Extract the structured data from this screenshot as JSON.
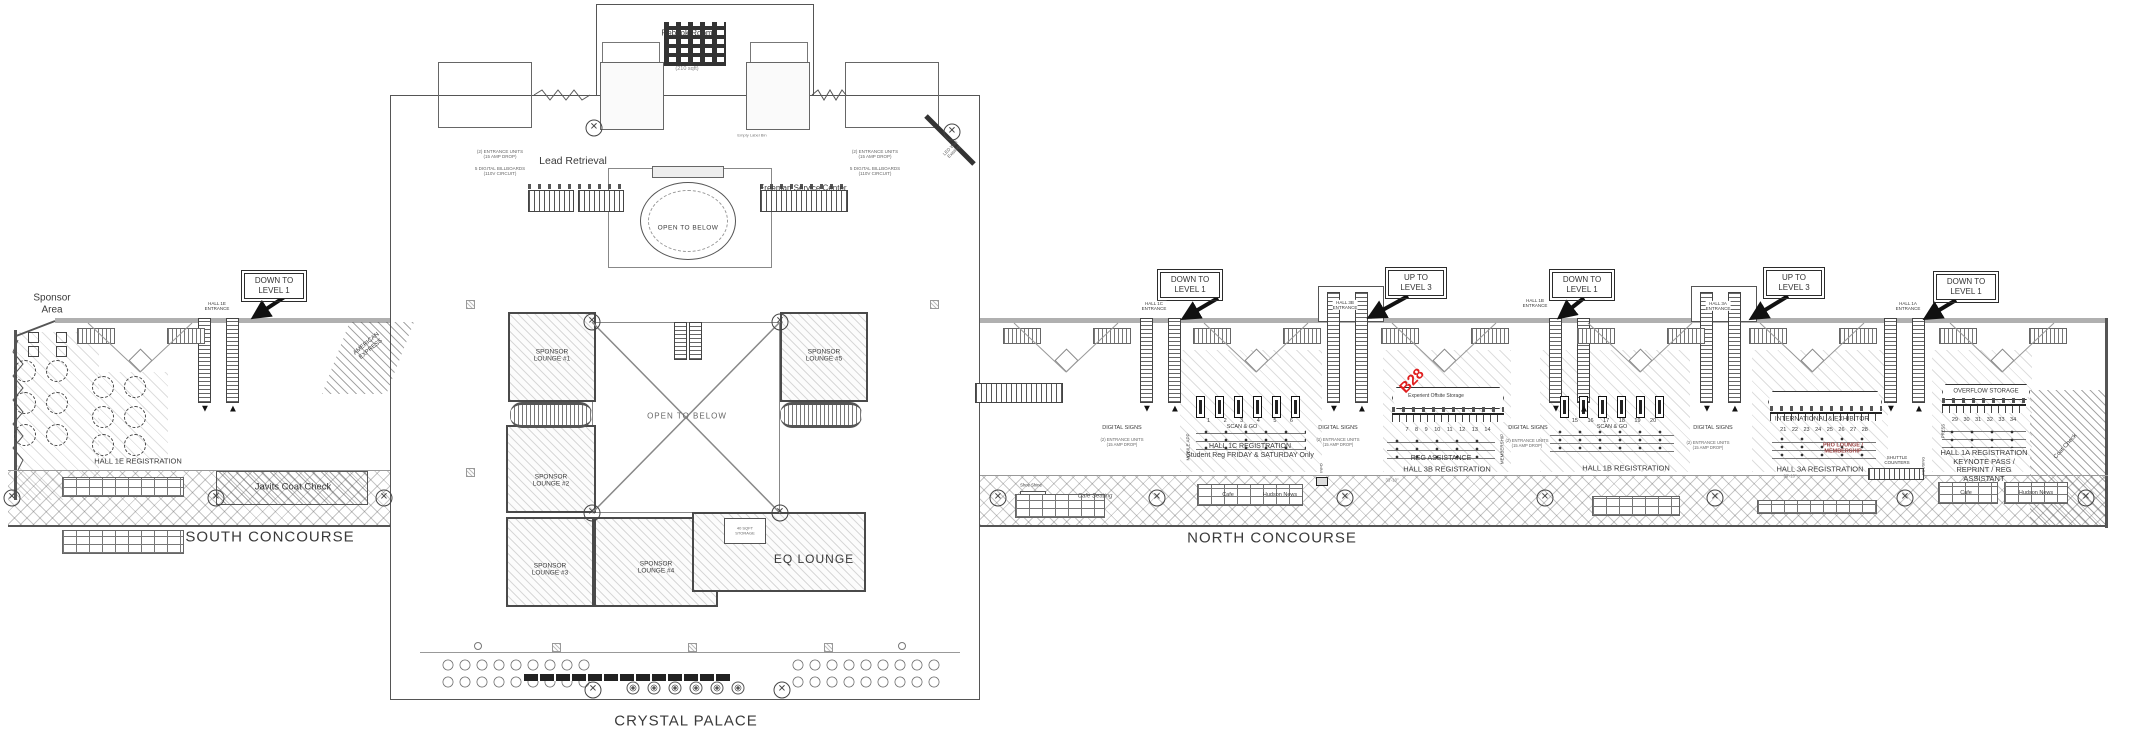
{
  "colors": {
    "b28_red": "#e01f1f",
    "pro_lounge_red": "#9c4444",
    "wall_gray": "#b0b0b0",
    "line": "#3c3c3c"
  },
  "icons": {
    "column_x": "✕",
    "esc_down": "▼",
    "esc_up": "▲"
  },
  "labels": {
    "rebook_room": "Rebook Room",
    "rebook_sqft": "(210 sqft)",
    "lead_retrieval": "Lead Retrieval",
    "freeman_service": "Freeman Service Center",
    "empty_label_bin": "Empty Label Bin",
    "open_to_below_rotunda": "OPEN TO BELOW",
    "open_to_below_atrium": "OPEN TO BELOW",
    "entrance_units": "(2) ENTRANCE UNITS\n(15 AMP DROP)",
    "digital_billboards": "5 DIGITAL BILLBOARDS\n(110V CIRCUIT)",
    "digital_signs": "DIGITAL SIGNS",
    "led_wall": "LED Wall\nExisting",
    "sponsor_area": "Sponsor\nArea",
    "hall_1e_registration": "HALL 1E REGISTRATION",
    "javits_coat_check": "Javits Coat Check",
    "american_express": "AMERICAN\nEXPRESS",
    "south_concourse": "SOUTH CONCOURSE",
    "north_concourse": "NORTH CONCOURSE",
    "crystal_palace": "CRYSTAL PALACE",
    "sponsor_lounge_1": "SPONSOR\nLOUNGE #1",
    "sponsor_lounge_2": "SPONSOR\nLOUNGE #2",
    "sponsor_lounge_3": "SPONSOR\nLOUNGE #3",
    "sponsor_lounge_4": "SPONSOR\nLOUNGE #4",
    "sponsor_lounge_5": "SPONSOR\nLOUNGE #5",
    "eq_lounge": "EQ LOUNGE",
    "storage_40": "40 SQFT\nSTORAGE",
    "down_to_level_1": "DOWN TO\nLEVEL 1",
    "up_to_level_3": "UP TO\nLEVEL 3",
    "hall_1e_entrance": "HALL 1E\nENTRANCE",
    "hall_1c_entrance": "HALL 1C\nENTRANCE",
    "hall_3b_entrance": "HALL 3B\nENTRANCE",
    "hall_1b_entrance": "HALL 1B\nENTRANCE",
    "hall_3a_entrance": "HALL 3A\nENTRANCE",
    "hall_1a_entrance": "HALL 1A\nENTRANCE",
    "scan_and_go": "SCAN & GO",
    "hall_1c_registration": "HALL 1C REGISTRATION",
    "hall_1c_registration_sub": "Student Reg FRIDAY & SATURDAY Only",
    "mobile_app": "MOBILE APP",
    "b28": "B28",
    "experient_storage": "Experient Offsite Storage",
    "reg_assistance": "REG ASSISTANCE",
    "hall_3b_registration": "HALL 3B REGISTRATION",
    "membership": "MEMBERSHIP",
    "hall_1b_registration": "HALL 1B REGISTRATION",
    "international_exhibitor": "INTERNATIONAL & EXHIBITOR",
    "pro_lounge": "PRO LOUNGE /\nMEMBERSHIP",
    "hall_3a_registration": "HALL 3A REGISTRATION",
    "overflow_storage": "OVERFLOW STORAGE",
    "press": "PRESS",
    "hall_1a_registration": "HALL 1A REGISTRATION\nKEYNOTE PASS /\nREPRINT / REG\nASSISTANT",
    "shuttle_counters": "SHUTTLE\nCOUNTERS",
    "housing": "HOUSING",
    "coat_check_corner": "Coat Check",
    "cafe_seating": "Cafe Seating",
    "shoe_shine": "Shoe Shine",
    "cafe": "Cafe",
    "hudson_news": "Hudson News",
    "info": "INFO",
    "nums_1c": "1 2 3 4 5 6",
    "nums_3b": "7 8 9 10 11 12 13 14",
    "nums_1b": "15 16 17 18 19 20",
    "nums_3a": "21 22 23 24 25 26 27 28",
    "nums_1a": "29 30 31 32 33 34",
    "dim_3b": "33'-10\"",
    "dim_3a": "33'-10\""
  }
}
